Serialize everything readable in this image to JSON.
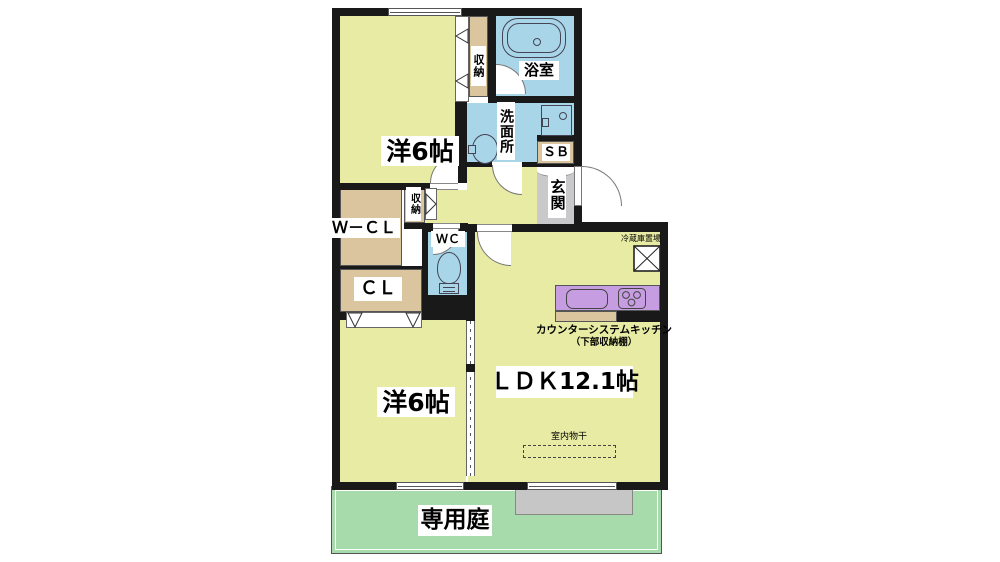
{
  "title": "2LDK apartment floor plan",
  "rooms": {
    "bedroom_top": "洋6帖",
    "bedroom_bottom": "洋6帖",
    "ldk": "ＬＤＫ12.1帖",
    "bathroom": "浴室",
    "washroom": "洗面所",
    "entrance": "玄関",
    "shoe_box": "ＳＢ",
    "walk_in_closet": "Ｗ－ＣＬ",
    "closet": "ＣＬ",
    "toilet": "ＷＣ",
    "storage_top": "収納",
    "storage_hall": "収納",
    "garden": "専用庭"
  },
  "annotations": {
    "kitchen_counter": "カウンターシステムキッチン",
    "kitchen_counter_sub": "（下部収納棚）",
    "fridge_space": "冷蔵庫置場",
    "indoor_drying": "室内物干"
  },
  "colors": {
    "floor_yellow": "#e8eba3",
    "wet_area_blue": "#a9d5e9",
    "closet_tan": "#dbc59e",
    "kitchen_purple": "#c59de0",
    "entrance_gray": "#c9c9cb",
    "garden_green": "#a8dbab",
    "terrace_gray": "#c6c6c6",
    "wall_black": "#191919"
  }
}
